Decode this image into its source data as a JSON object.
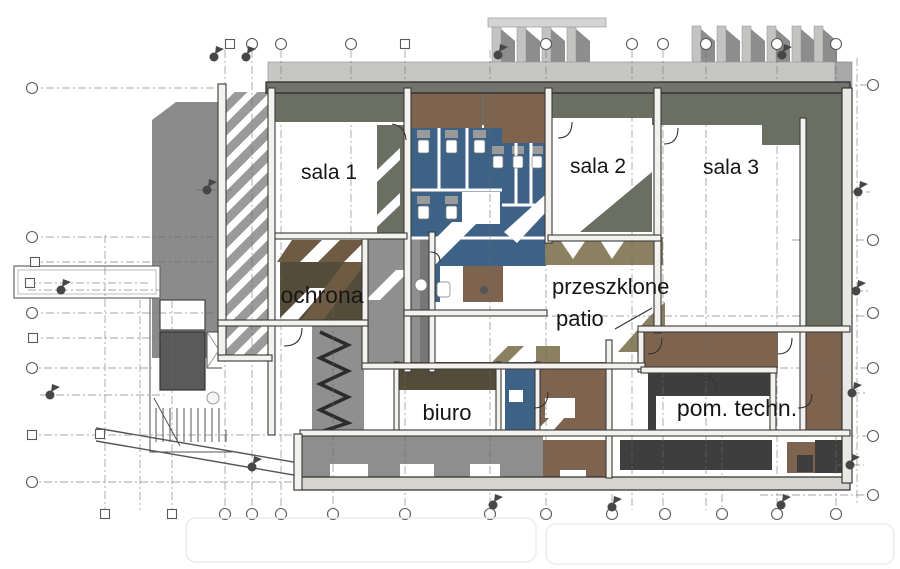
{
  "rooms": {
    "sala1": "sala 1",
    "sala2": "sala 2",
    "sala3": "sala 3",
    "ochrona": "ochrona",
    "patio_line1": "przeszklone",
    "patio_line2": "patio",
    "biuro": "biuro",
    "pom_techn": "pom. techn."
  },
  "colors": {
    "olive": "#6a6f62",
    "darkolive": "#524c38",
    "brown": "#7e644e",
    "brown2": "#6f5a43",
    "blue": "#3d6286",
    "khaki": "#8b8060",
    "canopy": "#c6c6c5",
    "finshadow": "#8d8d8d",
    "shadow": "#8b8b8b",
    "dark": "#3e3e3e",
    "corridor": "#8f8f8f",
    "wallline": "#3a3a3a",
    "ink": "#161616"
  },
  "fins": {
    "bars": [
      492,
      517,
      542,
      567,
      692,
      717,
      742,
      767,
      792,
      814
    ]
  },
  "grid": {
    "v": [
      [
        105,
        235,
        510
      ],
      [
        140,
        300,
        510
      ],
      [
        172,
        300,
        510
      ],
      [
        225,
        50,
        510
      ],
      [
        252,
        50,
        510
      ],
      [
        281,
        50,
        510
      ],
      [
        333,
        288,
        510
      ],
      [
        351,
        50,
        238
      ],
      [
        405,
        50,
        510
      ],
      [
        490,
        50,
        510
      ],
      [
        546,
        50,
        510
      ],
      [
        612,
        430,
        510
      ],
      [
        632,
        50,
        510
      ],
      [
        663,
        50,
        510
      ],
      [
        706,
        50,
        510
      ],
      [
        722,
        430,
        510
      ],
      [
        777,
        50,
        510
      ],
      [
        836,
        50,
        510
      ],
      [
        857,
        58,
        505
      ]
    ],
    "h": [
      [
        88,
        30,
        218
      ],
      [
        190,
        196,
        232
      ],
      [
        237,
        30,
        218
      ],
      [
        262,
        30,
        224
      ],
      [
        283,
        28,
        150
      ],
      [
        290,
        28,
        160
      ],
      [
        313,
        30,
        220
      ],
      [
        316,
        440,
        876
      ],
      [
        338,
        30,
        162
      ],
      [
        368,
        28,
        152
      ],
      [
        395,
        40,
        164
      ],
      [
        435,
        28,
        300
      ],
      [
        482,
        28,
        296
      ],
      [
        85,
        780,
        874
      ],
      [
        192,
        834,
        870
      ],
      [
        240,
        792,
        874
      ],
      [
        291,
        834,
        868
      ],
      [
        368,
        780,
        876
      ],
      [
        393,
        836,
        866
      ],
      [
        436,
        782,
        876
      ],
      [
        465,
        836,
        864
      ],
      [
        495,
        760,
        876
      ]
    ]
  },
  "markers": {
    "circles": [
      [
        252,
        44
      ],
      [
        281,
        44
      ],
      [
        351,
        44
      ],
      [
        546,
        44
      ],
      [
        632,
        44
      ],
      [
        663,
        44
      ],
      [
        706,
        44
      ],
      [
        777,
        44
      ],
      [
        836,
        44
      ],
      [
        225,
        514
      ],
      [
        252,
        514
      ],
      [
        281,
        514
      ],
      [
        333,
        514
      ],
      [
        405,
        514
      ],
      [
        490,
        514
      ],
      [
        546,
        514
      ],
      [
        612,
        514
      ],
      [
        665,
        514
      ],
      [
        722,
        514
      ],
      [
        777,
        514
      ],
      [
        836,
        514
      ],
      [
        32,
        88
      ],
      [
        32,
        237
      ],
      [
        32,
        313
      ],
      [
        32,
        368
      ],
      [
        32,
        482
      ],
      [
        873,
        85
      ],
      [
        873,
        240
      ],
      [
        873,
        313
      ],
      [
        873,
        368
      ],
      [
        873,
        436
      ],
      [
        873,
        495
      ]
    ],
    "squares": [
      [
        230,
        44
      ],
      [
        405,
        44
      ],
      [
        105,
        514
      ],
      [
        172,
        514
      ],
      [
        35,
        262
      ],
      [
        30,
        283
      ],
      [
        33,
        338
      ],
      [
        32,
        435
      ],
      [
        100,
        434
      ]
    ],
    "flags": [
      [
        214,
        57
      ],
      [
        246,
        57
      ],
      [
        498,
        55
      ],
      [
        782,
        55
      ],
      [
        61,
        290
      ],
      [
        50,
        395
      ],
      [
        252,
        467
      ],
      [
        493,
        505
      ],
      [
        612,
        507
      ],
      [
        781,
        505
      ],
      [
        858,
        192
      ],
      [
        856,
        291
      ],
      [
        852,
        393
      ],
      [
        850,
        465
      ],
      [
        207,
        190
      ]
    ]
  }
}
